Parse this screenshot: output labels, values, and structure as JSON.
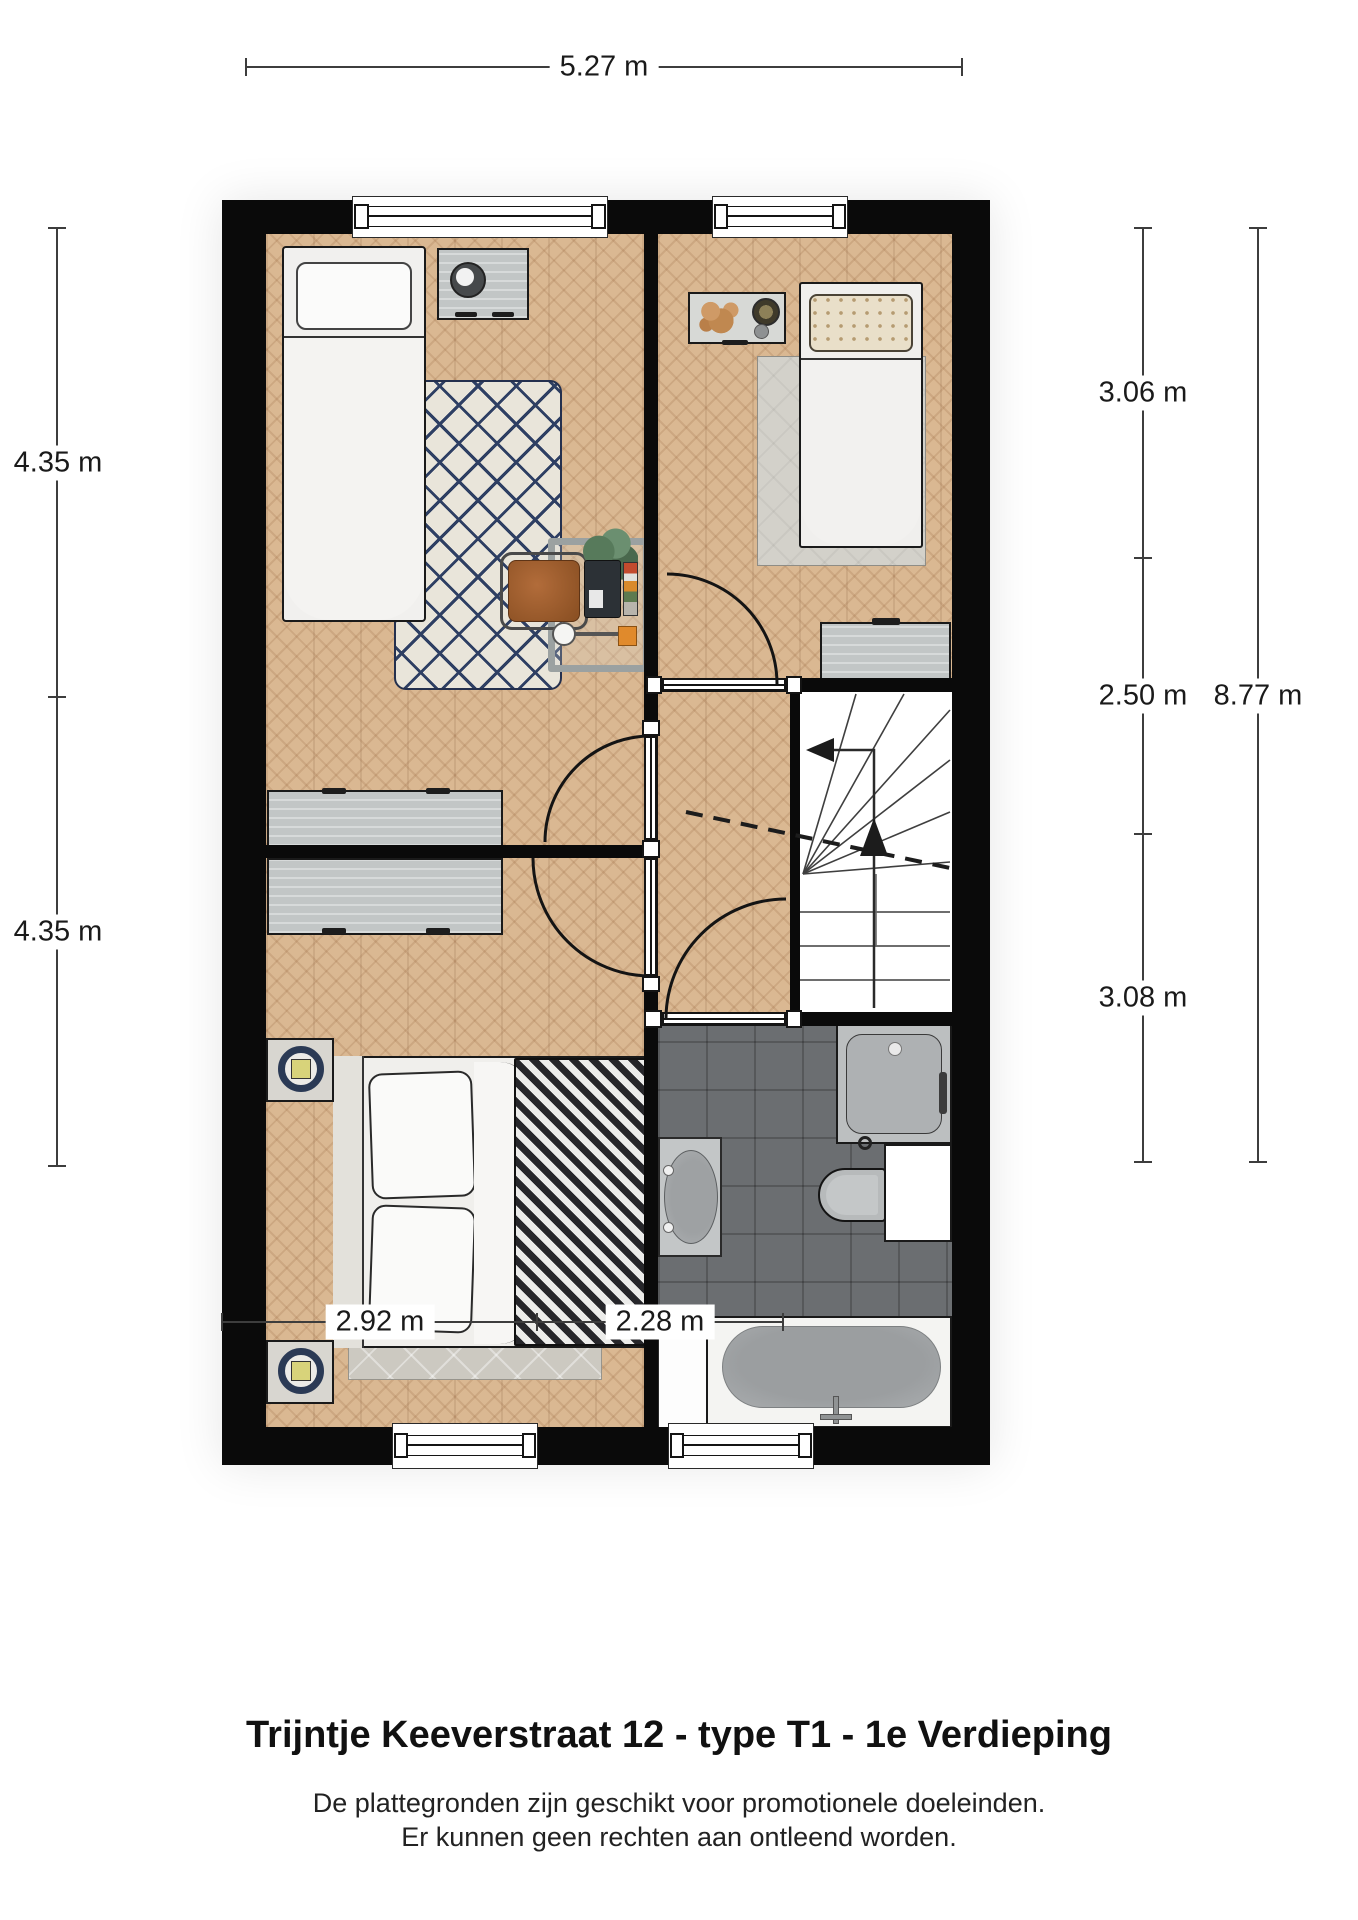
{
  "title": "Trijntje Keeverstraat 12 - type T1 - 1e Verdieping",
  "disclaimer": {
    "line1": "De plattegronden zijn geschikt voor promotionele doeleinden.",
    "line2": "Er kunnen geen rechten aan ontleend worden."
  },
  "dimensions": {
    "top_width": "5.27 m",
    "left": [
      "4.35 m",
      "4.35 m"
    ],
    "right": [
      "3.06 m",
      "2.50 m",
      "3.08 m"
    ],
    "right_total": "8.77 m",
    "bottom": [
      "2.92 m",
      "2.28 m"
    ]
  },
  "colors": {
    "wall": "#0a0a0a",
    "wood_floor": "#dab892",
    "tile_floor": "#6b6e71",
    "stairs": "#ffffff",
    "rug_navy": "#2e3f63",
    "lamp_navy": "#2b3a55",
    "accent_orange": "#e08a2c",
    "leather_chair": "#a9663a",
    "dim_line": "#3d3d3d"
  }
}
